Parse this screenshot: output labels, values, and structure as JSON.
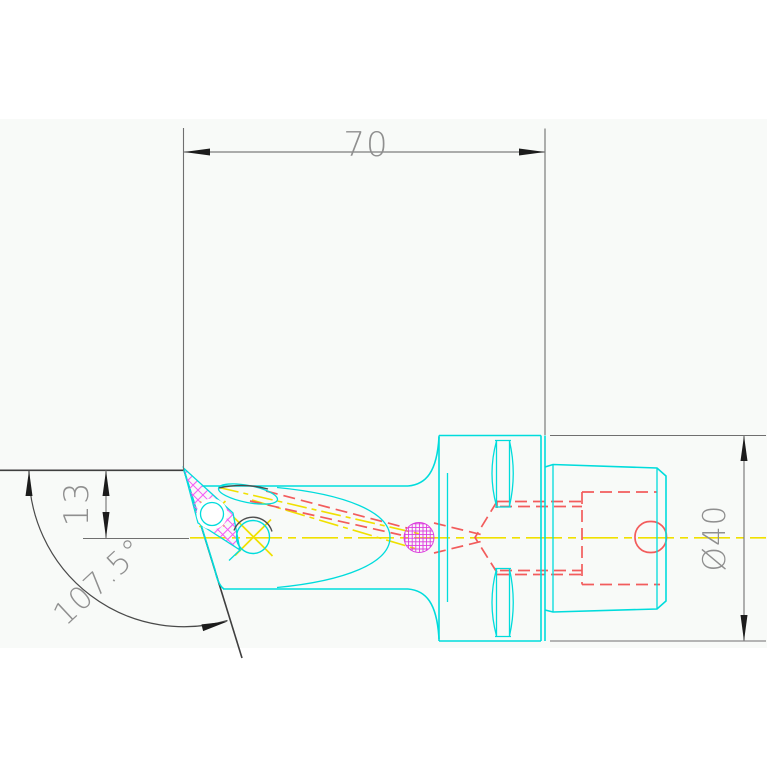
{
  "drawing": {
    "type": "cad-technical-drawing",
    "view": "tool-holder-side-view",
    "dimensions": {
      "overall_length": {
        "label": "70"
      },
      "tip_height": {
        "label": "13"
      },
      "face_angle": {
        "label": "107.5°"
      },
      "flange_diameter": {
        "label": "Ø40"
      }
    },
    "palette": {
      "outline_cyan": "#00dcdc",
      "hidden_red": "#f25c5c",
      "centerline_yellow": "#f0e000",
      "insert_magenta": "#f55af5",
      "hole_magenta": "#dd3cdd",
      "dimension_gray": "#7d7d7d",
      "arrow_black": "#1c1c1c",
      "text_gray": "#8f8f8f",
      "background": "#ffffff",
      "canvas_band": "#f8faf8"
    }
  }
}
